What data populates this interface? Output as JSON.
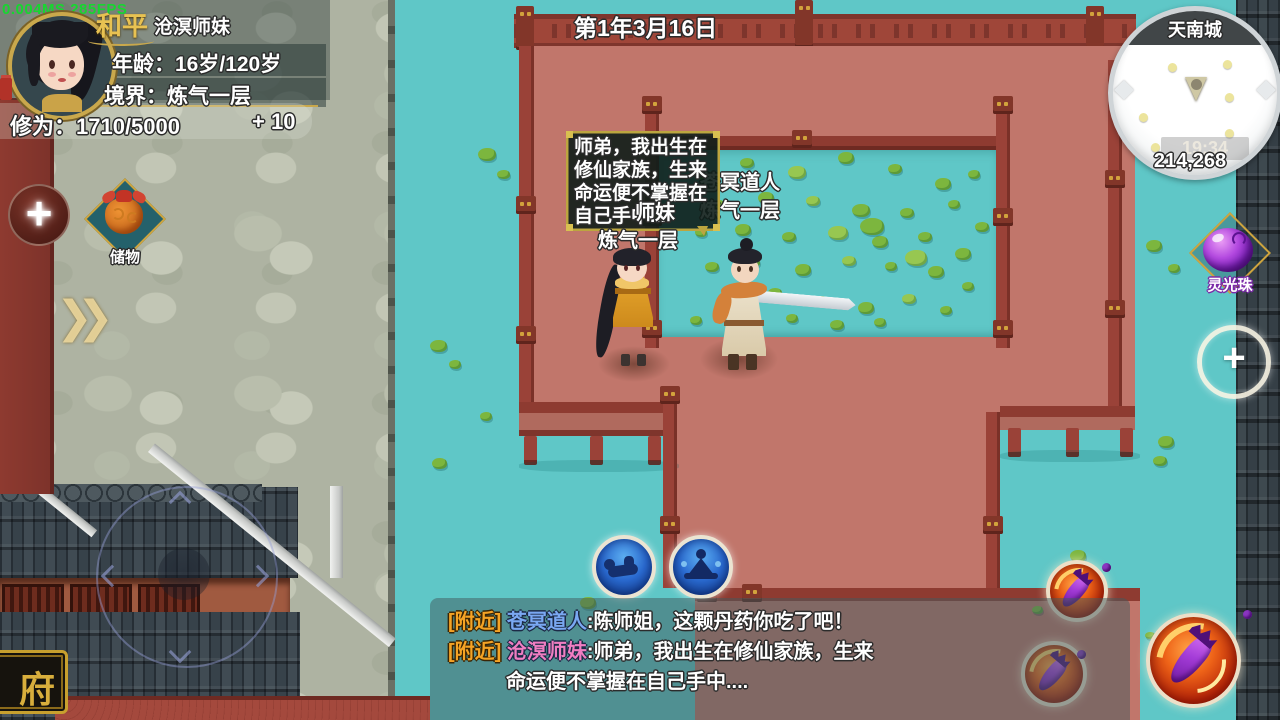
{
  "hud": {
    "fps": "0.004MS 285FPS",
    "player_panel": {
      "name": "和平",
      "title": "沧溟师妹",
      "age": "年龄：16岁/120岁",
      "realm": "境界：炼气一层",
      "cultivation": "修为：1710/5000",
      "gain": "+ 10"
    },
    "date": "第1年3月16日",
    "minimap": {
      "location": "天南城",
      "time": "19:34",
      "currency": "214,268"
    },
    "storage_item": {
      "label": "储物"
    },
    "orb_item": {
      "label": "灵光珠"
    },
    "add_left": "+",
    "add_right": "+",
    "chevron": "❯❯"
  },
  "scene": {
    "bubble_lines": [
      "师弟，我出生在",
      "修仙家族，生来",
      "命运便不掌握在",
      "自己手中...."
    ],
    "npc_name": "苍冥道人",
    "npc_realm": "炼气一层",
    "player_name_part": "师妹",
    "player_realm": "炼气一层",
    "plaque": "府"
  },
  "chat": {
    "messages": [
      {
        "channel": "[附近]",
        "name": "苍冥道人",
        "color": "#7aa8f2",
        "text": ":陈师姐，这颗丹药你吃了吧！"
      },
      {
        "channel": "[附近]",
        "name": "沧溟师妹",
        "color": "#f07ec2",
        "text": ":师弟，我出生在修仙家族，生来"
      },
      {
        "channel": "",
        "name": "",
        "color": "",
        "text": "命运便不掌握在自己手中...."
      }
    ]
  },
  "colors": {
    "water": "#5fc7c7",
    "building": "#c1766b",
    "railing": "#8e3b31",
    "accent_gold": "#c9a84c",
    "channel_orange": "#f5a325",
    "fps_green": "#17d630"
  }
}
